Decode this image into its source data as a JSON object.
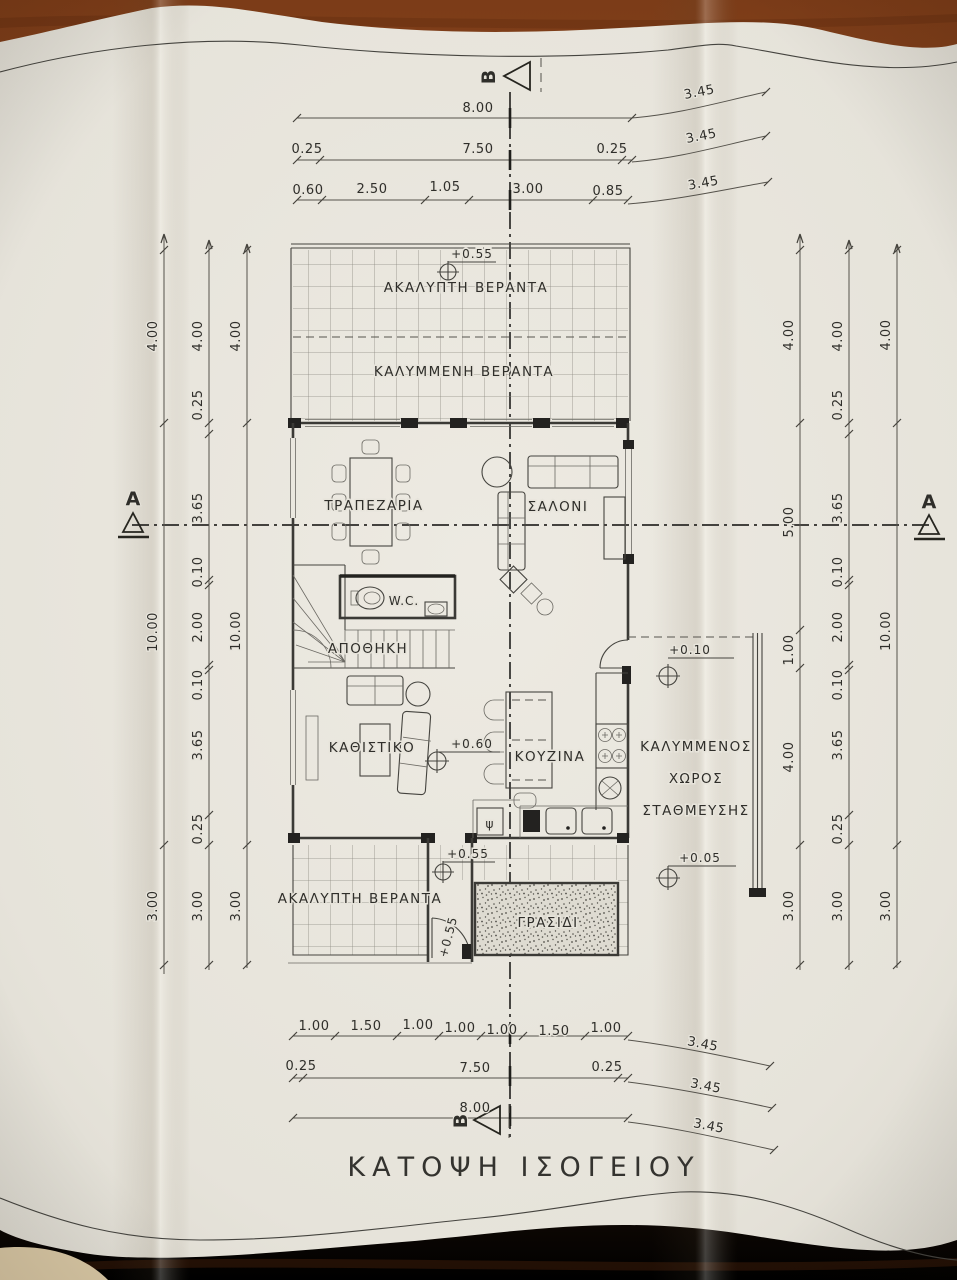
{
  "drawing": {
    "title": "ΚΑΤΟΨΗ ΙΣΟΓΕΙΟΥ",
    "section_top": "Β",
    "section_bottom": "Β",
    "section_left": "Α",
    "section_right": "Α",
    "rooms": {
      "veranda_open_top": "ΑΚΑΛΥΠΤΗ ΒΕΡΑΝΤΑ",
      "veranda_covered": "ΚΑΛΥΜΜΕΝΗ ΒΕΡΑΝΤΑ",
      "dining": "ΤΡΑΠΕΖΑΡΙΑ",
      "living": "ΣΑΛΟΝΙ",
      "wc": "W.C.",
      "storage": "ΑΠΟΘΗΚΗ",
      "sitting": "ΚΑΘΙΣΤΙΚΟ",
      "kitchen": "ΚΟΥΖΙΝΑ",
      "parking_1": "ΚΑΛΥΜΜΕΝΟΣ",
      "parking_2": "ΧΩΡΟΣ",
      "parking_3": "ΣΤΑΘΜΕΥΣΗΣ",
      "veranda_open_bottom": "ΑΚΑΛΥΠΤΗ ΒΕΡΑΝΤΑ",
      "grass": "ΓΡΑΣΙΔΙ",
      "fridge_symbol": "ψ"
    },
    "levels": {
      "top_veranda": "+0.55",
      "sitting": "+0.60",
      "parking_top": "+0.10",
      "parking_bottom": "+0.05",
      "bottom_veranda": "+0.55",
      "bottom_door": "+0.55"
    },
    "dims": {
      "top1": [
        "8.00"
      ],
      "top1d": "3.45",
      "top2": [
        "0.25",
        "7.50",
        "0.25"
      ],
      "top2d": "3.45",
      "top3": [
        "0.60",
        "2.50",
        "1.05",
        "3.00",
        "0.85"
      ],
      "top3d": "3.45",
      "bot1": [
        "1.00",
        "1.50",
        "1.00",
        "1.00",
        "1.00",
        "1.50",
        "1.00"
      ],
      "bot1d": "3.45",
      "bot2": [
        "0.25",
        "7.50",
        "0.25"
      ],
      "bot2d": "3.45",
      "bot3": [
        "8.00"
      ],
      "bot3d": "3.45",
      "left_outer": [
        "4.00",
        "10.00",
        "3.00"
      ],
      "left_mid": [
        "4.00",
        "0.25",
        "3.65",
        "0.10",
        "2.00",
        "0.10",
        "3.65",
        "0.25",
        "3.00"
      ],
      "left_inner": [
        "4.00",
        "10.00",
        "3.00"
      ],
      "right_inner": [
        "4.00",
        "5.00",
        "1.00",
        "4.00",
        "3.00"
      ],
      "right_mid": [
        "4.00",
        "0.25",
        "3.65",
        "0.10",
        "2.00",
        "0.10",
        "3.65",
        "0.25",
        "3.00"
      ],
      "right_outer": [
        "4.00",
        "10.00",
        "3.00"
      ]
    }
  }
}
